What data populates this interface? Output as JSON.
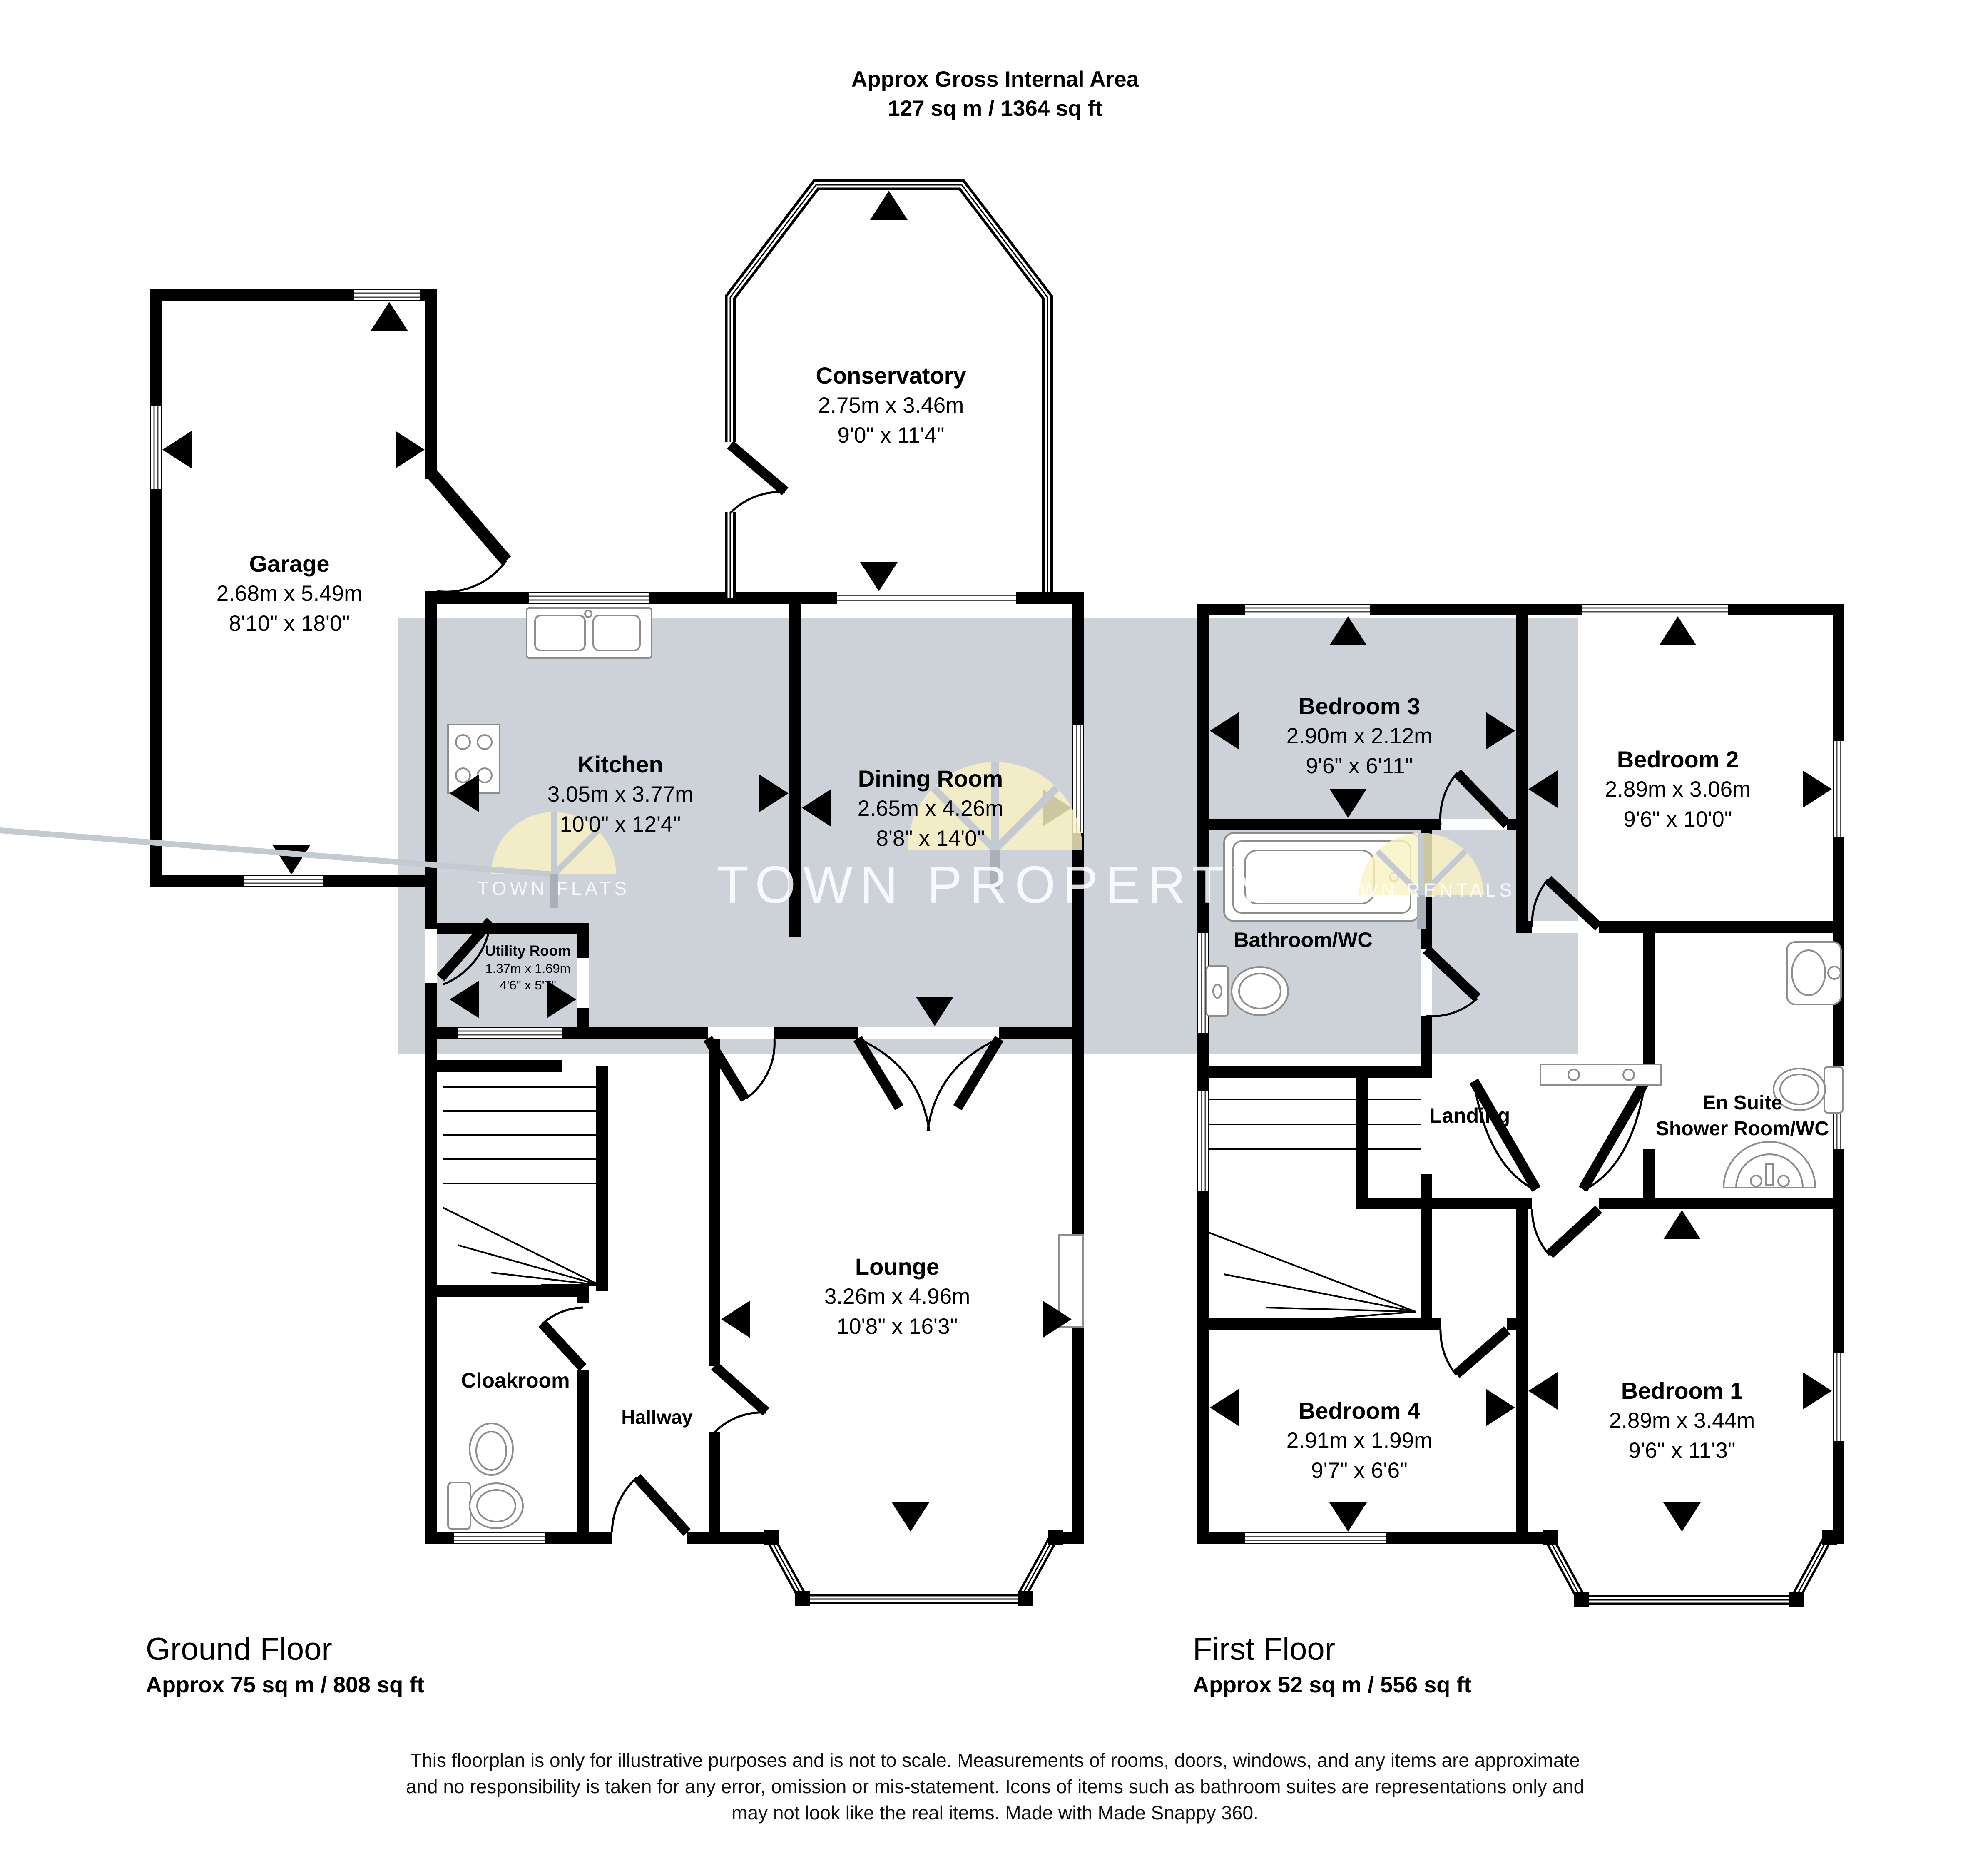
{
  "header": {
    "title_line1": "Approx Gross Internal Area",
    "title_line2": "127 sq m / 1364 sq ft"
  },
  "watermarks": {
    "left": "TOWN FLATS",
    "center": "TOWN PROPERTY",
    "right": "TOWN RENTALS"
  },
  "colors": {
    "wall": "#000000",
    "band": "#cdd2d8",
    "fan_yellow": "#f9f2c2",
    "watermark_text": "#ffffff"
  },
  "ground_floor": {
    "caption": "Ground Floor",
    "area": "Approx 75 sq m / 808 sq ft",
    "rooms": {
      "garage": {
        "name": "Garage",
        "metric": "2.68m x 5.49m",
        "imperial": "8'10\" x 18'0\""
      },
      "conservatory": {
        "name": "Conservatory",
        "metric": "2.75m x 3.46m",
        "imperial": "9'0\" x 11'4\""
      },
      "kitchen": {
        "name": "Kitchen",
        "metric": "3.05m x 3.77m",
        "imperial": "10'0\" x 12'4\""
      },
      "dining": {
        "name": "Dining Room",
        "metric": "2.65m x 4.26m",
        "imperial": "8'8\" x 14'0\""
      },
      "utility": {
        "name": "Utility Room",
        "metric": "1.37m x 1.69m",
        "imperial": "4'6\" x 5'7\""
      },
      "lounge": {
        "name": "Lounge",
        "metric": "3.26m x 4.96m",
        "imperial": "10'8\" x 16'3\""
      },
      "cloakroom": {
        "name": "Cloakroom"
      },
      "hallway": {
        "name": "Hallway"
      }
    }
  },
  "first_floor": {
    "caption": "First Floor",
    "area": "Approx 52 sq m / 556 sq ft",
    "rooms": {
      "bedroom3": {
        "name": "Bedroom 3",
        "metric": "2.90m x 2.12m",
        "imperial": "9'6\" x 6'11\""
      },
      "bedroom2": {
        "name": "Bedroom 2",
        "metric": "2.89m x 3.06m",
        "imperial": "9'6\" x 10'0\""
      },
      "bathroom": {
        "name": "Bathroom/WC"
      },
      "landing": {
        "name": "Landing"
      },
      "ensuite": {
        "line1": "En Suite",
        "line2": "Shower Room/WC"
      },
      "bedroom4": {
        "name": "Bedroom 4",
        "metric": "2.91m x 1.99m",
        "imperial": "9'7\" x 6'6\""
      },
      "bedroom1": {
        "name": "Bedroom 1",
        "metric": "2.89m x 3.44m",
        "imperial": "9'6\" x 11'3\""
      }
    }
  },
  "footer": {
    "disclaimer_line1": "This floorplan is only for illustrative purposes and is not to scale. Measurements of rooms, doors, windows, and any items are approximate",
    "disclaimer_line2": "and no responsibility is taken for any error, omission or mis-statement. Icons of items such as bathroom suites are representations only and",
    "disclaimer_line3": "may not look like the real items. Made with Made Snappy 360."
  }
}
